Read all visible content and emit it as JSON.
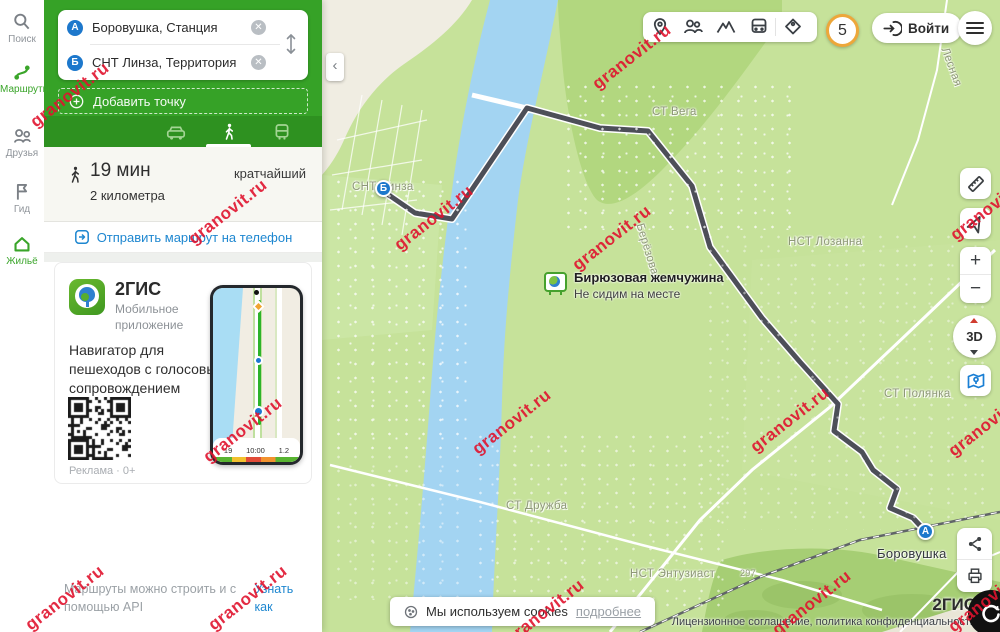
{
  "watermark": {
    "text": "granovit.ru",
    "positions": [
      [
        70,
        95
      ],
      [
        632,
        57
      ],
      [
        228,
        212
      ],
      [
        434,
        218
      ],
      [
        612,
        238
      ],
      [
        990,
        208
      ],
      [
        243,
        430
      ],
      [
        512,
        422
      ],
      [
        790,
        420
      ],
      [
        988,
        424
      ],
      [
        65,
        598
      ],
      [
        248,
        598
      ],
      [
        545,
        612
      ],
      [
        812,
        603
      ],
      [
        988,
        600
      ]
    ]
  },
  "sidebar": {
    "items": [
      {
        "label": "Поиск",
        "icon": "search-icon",
        "active": false
      },
      {
        "label": "Маршруты",
        "icon": "route-icon",
        "active": true
      },
      {
        "label": "Друзья",
        "icon": "friends-icon",
        "active": false
      },
      {
        "label": "Гид",
        "icon": "flag-icon",
        "active": false
      },
      {
        "label": "Жильё",
        "icon": "home-icon",
        "active": true
      }
    ]
  },
  "route_panel": {
    "point_a": {
      "letter": "А",
      "value": "Боровушка, Станция"
    },
    "point_b": {
      "letter": "Б",
      "value": "СНТ Линза, Территория"
    },
    "add_point": "Добавить точку",
    "summary": {
      "duration": "19 мин",
      "distance": "2 километра",
      "kind": "кратчайший"
    },
    "send_link": "Отправить маршрут на телефон",
    "promo": {
      "title": "2ГИС",
      "subtitle": "Мобильное приложение",
      "text": "Навигатор для пешеходов с голосовым сопровождением",
      "ad_mark": "Реклама · 0+"
    },
    "api_note": {
      "text": "Маршруты можно строить и с помощью API",
      "link": "Узнать как"
    }
  },
  "topbar": {
    "badge": "5",
    "login": "Войти"
  },
  "phone": {
    "stats": {
      "eta": "19",
      "time": "10:00",
      "dist": "1.2"
    }
  },
  "map": {
    "labels": [
      {
        "text": "СТ Вега",
        "x": 330,
        "y": 106
      },
      {
        "text": "СНТ Линза",
        "x": 30,
        "y": 181
      },
      {
        "text": "НСТ Лозанна",
        "x": 466,
        "y": 236
      },
      {
        "text": "СТ Полянка",
        "x": 562,
        "y": 388
      },
      {
        "text": "СТ Дружба",
        "x": 184,
        "y": 500
      },
      {
        "text": "НСТ Энтузиаст",
        "x": 308,
        "y": 568
      },
      {
        "text": "297",
        "x": 418,
        "y": 568,
        "size": 9
      },
      {
        "text": "Берёзовая",
        "x": 323,
        "y": 222,
        "rotate": 73
      },
      {
        "text": "Лесная",
        "x": 628,
        "y": 46,
        "rotate": 70
      },
      {
        "text": "Боровушка",
        "x": 555,
        "y": 546,
        "dark": true
      }
    ],
    "markers": [
      {
        "letter": "Б",
        "x": 53,
        "y": 180
      },
      {
        "letter": "А",
        "x": 595,
        "y": 523
      }
    ],
    "ad_poi": {
      "title": "Бирюзовая жемчужина",
      "subtitle": "Не сидим на месте"
    },
    "cookie_bar": {
      "text": "Мы используем cookies",
      "link": "подробнее"
    },
    "attribution": {
      "brand": "2ГИС",
      "legal": "Лицензионное соглашение, политика конфиденциальности"
    },
    "controls": {
      "zoom_in": "+",
      "zoom_out": "−",
      "dial": "3D"
    }
  }
}
